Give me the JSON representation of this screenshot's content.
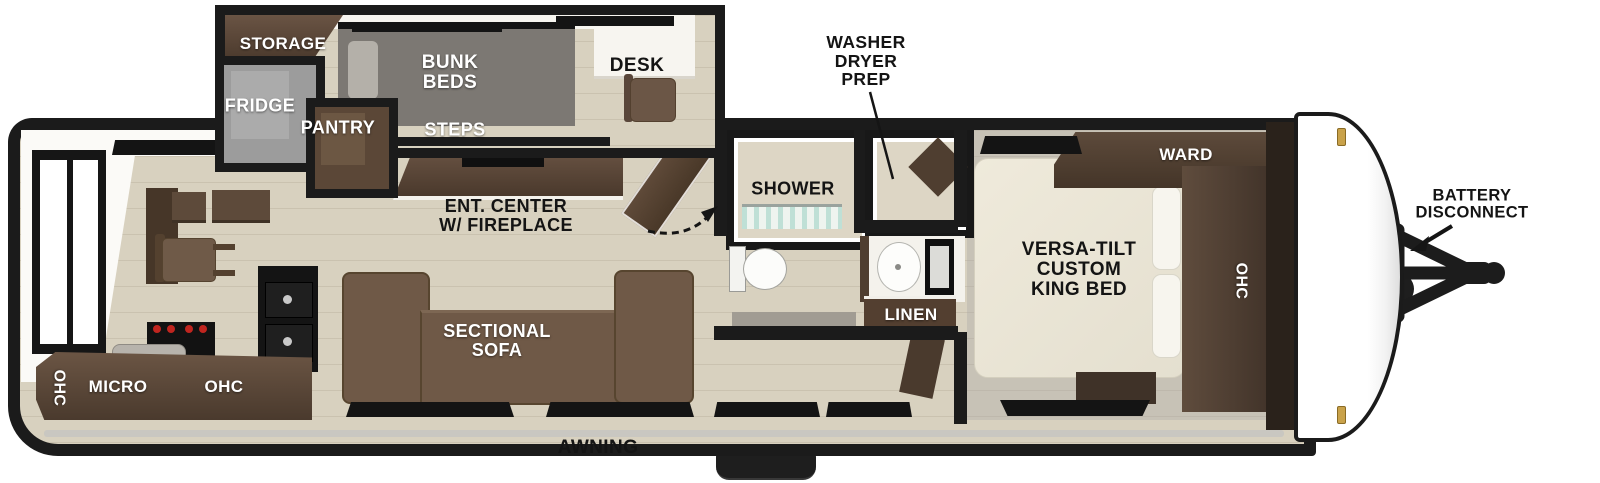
{
  "diagram_type": "travel-trailer floor plan",
  "labels": {
    "storage": "STORAGE",
    "fridge": "FRIDGE",
    "pantry": "PANTRY",
    "bunk_beds": "BUNK\nBEDS",
    "steps": "STEPS",
    "desk": "DESK",
    "washer_dryer_prep": "WASHER\nDRYER\nPREP",
    "shower": "SHOWER",
    "linen": "LINEN",
    "ent_center": "ENT. CENTER\nW/ FIREPLACE",
    "sectional_sofa": "SECTIONAL\nSOFA",
    "ohc_rear_vertical": "OHC",
    "micro": "MICRO",
    "ohc_kitchen": "OHC",
    "awning": "AWNING",
    "ward": "WARD",
    "king_bed": "VERSA-TILT\nCUSTOM\nKING BED",
    "ohc_bedroom": "OHC",
    "battery_disconnect": "BATTERY\nDISCONNECT"
  },
  "colors": {
    "wall": "#1b1b1b",
    "floor_wood": "#d8d1bf",
    "floor_carpet": "#c7c2b6",
    "cabinet_dark": "#4a392c",
    "cabinet_medium": "#5d4a3b",
    "sofa_brown": "#6f5947",
    "bunk_gray": "#7c7873",
    "fridge_gray": "#9c9c9c",
    "mattress_cream": "#ece8da",
    "accent_gold": "#c9a24a",
    "shower_aqua": "#bfe0d6",
    "stove_knob_red": "#c0251f",
    "label_white": "#ffffff",
    "label_black": "#141414"
  }
}
